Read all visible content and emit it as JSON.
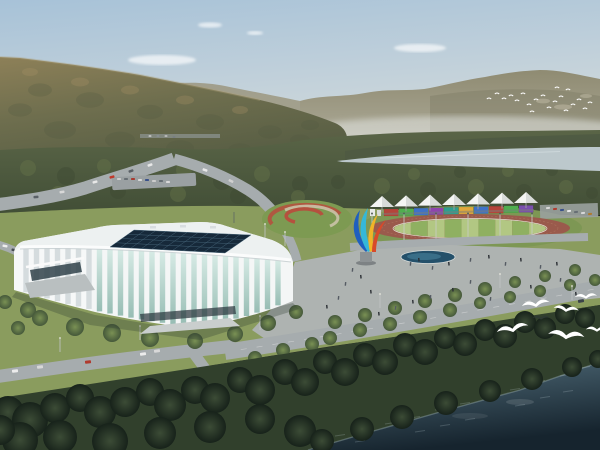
{
  "scene": {
    "description": "Aerial rendering of a lakeside sports park: white lattice gymnasium with navy glass skylight roof, athletics track with rainbow grandstand and white canopy tents, colorful ribbon sculpture, plazas with pedestrians, tree-lined roads, forested mountains, a pale river, flying egrets and dark blue water in the foreground."
  },
  "palette": {
    "sky_top": "#a7c2d8",
    "sky_haze": "#dadfe0",
    "far_range": "#8f8b72",
    "far_range_base": "#b0ac9a",
    "ridge_haze": "#9b977f",
    "mountain_light": "#97875f",
    "mountain_dark": "#5e6246",
    "forest": "#5a6547",
    "forest_dark": "#414e36",
    "river": "#bcc8cc",
    "lawn": "#8a9c5e",
    "plaza": "#aeb3b1",
    "road": "#a6acae",
    "track": "#9a5a4c",
    "field_light": "#b2c783",
    "field_dark": "#8fb061",
    "facade": "#f4f6f6",
    "roof": "#edf1f1",
    "glass_top": "#d3e9e3",
    "glass_bottom": "#8fb8ae",
    "skylight": "#16293a",
    "skylight_grid": "#4a6a7e",
    "water_top": "#54707e",
    "water_deep": "#16242e",
    "shadow": "#2f3a33",
    "bird": "#ffffff",
    "tent": "#f4f5f3",
    "tent_shade": "#d8dbd9"
  },
  "sky": {
    "clouds": [
      [
        162,
        60,
        34,
        5
      ],
      [
        210,
        25,
        12,
        2.6
      ],
      [
        255,
        33,
        8,
        2
      ],
      [
        420,
        48,
        26,
        4
      ]
    ]
  },
  "mountains": {
    "scree": [
      [
        543,
        101,
        7,
        2.4
      ],
      [
        563,
        107,
        9,
        2.6
      ],
      [
        586,
        96,
        6,
        2
      ]
    ],
    "dark_blotches": [
      [
        40,
        90,
        12
      ],
      [
        90,
        100,
        14
      ],
      [
        150,
        112,
        13
      ],
      [
        210,
        122,
        14
      ],
      [
        270,
        132,
        12
      ],
      [
        60,
        130,
        16
      ],
      [
        120,
        140,
        15
      ],
      [
        180,
        148,
        14
      ],
      [
        240,
        150,
        12
      ],
      [
        300,
        140,
        10
      ],
      [
        20,
        110,
        12
      ],
      [
        310,
        125,
        9
      ]
    ],
    "light_blotches": [
      [
        30,
        72,
        8
      ],
      [
        80,
        82,
        9
      ],
      [
        130,
        90,
        9
      ],
      [
        185,
        100,
        9
      ],
      [
        240,
        110,
        8
      ]
    ]
  },
  "forest": {
    "texture": [
      [
        28,
        168,
        8
      ],
      [
        66,
        176,
        9
      ],
      [
        104,
        166,
        7
      ],
      [
        142,
        178,
        9
      ],
      [
        184,
        170,
        8
      ],
      [
        222,
        181,
        9
      ],
      [
        262,
        174,
        8
      ],
      [
        300,
        184,
        8
      ],
      [
        58,
        193,
        7
      ],
      [
        118,
        191,
        8
      ],
      [
        178,
        194,
        8
      ],
      [
        238,
        196,
        8
      ],
      [
        298,
        197,
        7
      ],
      [
        338,
        182,
        7
      ],
      [
        382,
        186,
        8
      ],
      [
        428,
        190,
        8
      ],
      [
        476,
        187,
        8
      ],
      [
        524,
        192,
        8
      ],
      [
        566,
        187,
        7
      ],
      [
        592,
        193,
        6
      ],
      [
        414,
        174,
        6
      ],
      [
        460,
        172,
        6
      ],
      [
        508,
        171,
        6
      ],
      [
        552,
        170,
        6
      ]
    ]
  },
  "stadium": {
    "rim": [
      [
        16,
        252
      ],
      [
        22,
        247
      ],
      [
        60,
        246
      ],
      [
        120,
        248
      ],
      [
        180,
        251
      ],
      [
        240,
        255
      ],
      [
        291,
        260
      ]
    ],
    "bottom": [
      [
        14,
        290
      ],
      [
        40,
        298
      ],
      [
        70,
        306
      ],
      [
        100,
        313
      ],
      [
        130,
        319
      ],
      [
        160,
        324
      ],
      [
        185,
        327
      ],
      [
        215,
        325
      ],
      [
        245,
        318
      ],
      [
        270,
        310
      ],
      [
        293,
        301
      ]
    ],
    "rib_start": 26,
    "rib_end": 288,
    "rib_step": 10.5,
    "rib_width": 5.4,
    "left_face_max_x": 92,
    "skylight": {
      "corners": [
        [
          110,
          247
        ],
        [
          134,
          230
        ],
        [
          251,
          235
        ],
        [
          225,
          253
        ]
      ],
      "cols": 11,
      "rows": 4
    }
  },
  "grandstand": {
    "panel_colors": [
      "#b5443a",
      "#4fae4f",
      "#3f72c8",
      "#8e44ad",
      "#2e9e8f",
      "#e0a83c",
      "#3f72c8",
      "#b5443a",
      "#4fae4f",
      "#7a4fae"
    ],
    "panel_area": {
      "x0": 384,
      "x1": 534,
      "y_left": 209,
      "y_right": 205,
      "height": 7
    },
    "tents": {
      "count": 7,
      "x0": 382,
      "step": 24,
      "base_left": 207,
      "base_right": 203,
      "half_width": 12,
      "peak": 11
    },
    "flagpole_xs": [
      372,
      404,
      436,
      468,
      500,
      532
    ]
  },
  "track": {
    "cx": 470,
    "cy": 228,
    "rx_outer": 100,
    "ry_outer": 14,
    "rx_in": 76,
    "ry_in": 9.5,
    "stripes": 9
  },
  "roundabout": {
    "cx": 307,
    "cy": 219,
    "rx": 45,
    "ry": 19
  },
  "sculpture": {
    "colors": [
      "#1f5fbf",
      "#35b8d8",
      "#f0b428",
      "#d84a2a"
    ]
  },
  "trees": {
    "mid": [
      [
        5,
        302,
        7
      ],
      [
        28,
        310,
        8
      ],
      [
        40,
        318,
        8
      ],
      [
        75,
        327,
        9
      ],
      [
        112,
        333,
        9
      ],
      [
        150,
        338,
        9
      ],
      [
        195,
        341,
        8
      ],
      [
        235,
        334,
        8
      ],
      [
        268,
        323,
        8
      ],
      [
        296,
        312,
        7
      ],
      [
        18,
        328,
        7
      ],
      [
        255,
        358,
        7
      ],
      [
        283,
        350,
        7
      ],
      [
        312,
        344,
        7
      ],
      [
        335,
        322,
        7
      ],
      [
        365,
        315,
        7
      ],
      [
        395,
        308,
        7
      ],
      [
        425,
        301,
        7
      ],
      [
        455,
        295,
        7
      ],
      [
        485,
        289,
        7
      ],
      [
        515,
        282,
        6
      ],
      [
        545,
        276,
        6
      ],
      [
        575,
        270,
        6
      ],
      [
        330,
        338,
        7
      ],
      [
        360,
        330,
        7
      ],
      [
        390,
        324,
        7
      ],
      [
        420,
        317,
        7
      ],
      [
        450,
        310,
        7
      ],
      [
        480,
        303,
        6
      ],
      [
        510,
        297,
        6
      ],
      [
        540,
        291,
        6
      ],
      [
        570,
        285,
        6
      ],
      [
        595,
        280,
        6
      ]
    ],
    "fore": [
      [
        8,
        412,
        16
      ],
      [
        30,
        420,
        18
      ],
      [
        55,
        408,
        15
      ],
      [
        80,
        398,
        14
      ],
      [
        100,
        412,
        16
      ],
      [
        125,
        402,
        15
      ],
      [
        150,
        392,
        14
      ],
      [
        170,
        405,
        16
      ],
      [
        195,
        390,
        14
      ],
      [
        215,
        398,
        15
      ],
      [
        240,
        380,
        13
      ],
      [
        260,
        390,
        15
      ],
      [
        285,
        372,
        13
      ],
      [
        305,
        382,
        14
      ],
      [
        325,
        362,
        12
      ],
      [
        345,
        372,
        14
      ],
      [
        365,
        355,
        12
      ],
      [
        385,
        362,
        13
      ],
      [
        405,
        345,
        12
      ],
      [
        425,
        352,
        13
      ],
      [
        445,
        338,
        11
      ],
      [
        465,
        344,
        12
      ],
      [
        485,
        330,
        11
      ],
      [
        505,
        336,
        12
      ],
      [
        525,
        322,
        11
      ],
      [
        545,
        328,
        11
      ],
      [
        565,
        314,
        10
      ],
      [
        585,
        318,
        10
      ],
      [
        20,
        440,
        18
      ],
      [
        60,
        437,
        17
      ],
      [
        110,
        441,
        18
      ],
      [
        160,
        433,
        16
      ],
      [
        210,
        427,
        16
      ],
      [
        260,
        419,
        15
      ],
      [
        300,
        431,
        16
      ],
      [
        0,
        430,
        15
      ]
    ],
    "shore": [
      [
        322,
        441,
        12
      ],
      [
        362,
        429,
        12
      ],
      [
        402,
        417,
        12
      ],
      [
        446,
        403,
        12
      ],
      [
        490,
        391,
        11
      ],
      [
        532,
        379,
        11
      ],
      [
        572,
        367,
        10
      ],
      [
        598,
        359,
        9
      ]
    ]
  },
  "vehicles": [
    [
      150,
      165,
      5,
      2.5,
      "#e8e8e8",
      -18
    ],
    [
      131,
      171,
      5,
      2.5,
      "#5a6066",
      -18
    ],
    [
      112,
      177,
      5,
      2.5,
      "#c0392b",
      -16
    ],
    [
      95,
      182,
      5,
      2.5,
      "#e8e8e8",
      -14
    ],
    [
      62,
      192,
      5,
      2.5,
      "#d8d8d8",
      -8
    ],
    [
      36,
      197,
      5,
      2.5,
      "#5a6066",
      -6
    ],
    [
      205,
      170,
      5,
      2.5,
      "#e8e8e8",
      20
    ],
    [
      231,
      181,
      5,
      2.5,
      "#d0d0d0",
      26
    ],
    [
      5,
      246,
      5,
      2.5,
      "#eeeeee",
      10
    ],
    [
      14,
      250,
      5,
      2.5,
      "#444a50",
      10
    ],
    [
      15,
      371,
      6,
      3,
      "#ececec",
      -6
    ],
    [
      40,
      367,
      6,
      3,
      "#d8d8d8",
      -6
    ],
    [
      88,
      362,
      6,
      3,
      "#b03a2e",
      -7
    ],
    [
      143,
      354,
      6,
      3,
      "#ececec",
      -8
    ],
    [
      157,
      351,
      6,
      3,
      "#d8d8d8",
      -8
    ],
    [
      512,
      341,
      7,
      3.5,
      "#f2f2f2",
      -10
    ],
    [
      581,
      301,
      6,
      3,
      "#3a4248",
      -10
    ],
    [
      119,
      179,
      4,
      2,
      "#cccccc",
      0
    ],
    [
      126,
      179,
      4,
      2,
      "#666e74",
      0
    ],
    [
      133,
      179,
      4,
      2,
      "#a83a30",
      0
    ],
    [
      140,
      180,
      4,
      2,
      "#d8d8d8",
      0
    ],
    [
      147,
      180,
      4,
      2,
      "#39518a",
      0
    ],
    [
      154,
      181,
      4,
      2,
      "#cccccc",
      0
    ],
    [
      161,
      181,
      4,
      2,
      "#666e74",
      0
    ],
    [
      168,
      182,
      4,
      2,
      "#d8d8d8",
      0
    ],
    [
      150,
      136,
      3,
      1.5,
      "#d0d0d0",
      0
    ],
    [
      158,
      136,
      3,
      1.5,
      "#8a9096",
      0
    ],
    [
      166,
      136,
      3,
      1.5,
      "#c8c8c8",
      0
    ],
    [
      174,
      137,
      3,
      1.5,
      "#777d83",
      0
    ],
    [
      548,
      208,
      4,
      2,
      "#d8d8d8",
      -4
    ],
    [
      555,
      209,
      4,
      2,
      "#b03a2e",
      -4
    ],
    [
      562,
      210,
      4,
      2,
      "#39518a",
      -4
    ],
    [
      569,
      211,
      4,
      2,
      "#e8e8e8",
      -4
    ],
    [
      576,
      212,
      4,
      2,
      "#666e74",
      -4
    ],
    [
      583,
      213,
      4,
      2,
      "#d8d8d8",
      -4
    ],
    [
      590,
      214,
      4,
      2,
      "#b07a2e",
      -4
    ]
  ],
  "people": [
    [
      352,
      268
    ],
    [
      360,
      275
    ],
    [
      345,
      282
    ],
    [
      370,
      290
    ],
    [
      410,
      262
    ],
    [
      418,
      258
    ],
    [
      432,
      266
    ],
    [
      448,
      262
    ],
    [
      470,
      258
    ],
    [
      488,
      255
    ],
    [
      505,
      262
    ],
    [
      520,
      258
    ],
    [
      540,
      265
    ],
    [
      556,
      262
    ],
    [
      470,
      280
    ],
    [
      452,
      288
    ],
    [
      430,
      295
    ],
    [
      412,
      300
    ],
    [
      395,
      306
    ],
    [
      378,
      312
    ],
    [
      490,
      297
    ],
    [
      530,
      285
    ],
    [
      560,
      278
    ],
    [
      575,
      292
    ],
    [
      338,
      296
    ],
    [
      326,
      305
    ]
  ],
  "poles": [
    [
      60,
      352
    ],
    [
      140,
      340
    ],
    [
      260,
      330
    ],
    [
      380,
      308
    ],
    [
      500,
      288
    ],
    [
      572,
      300
    ],
    [
      265,
      238
    ],
    [
      285,
      246
    ]
  ],
  "birds": {
    "flock": [
      [
        489,
        99
      ],
      [
        497,
        94
      ],
      [
        504,
        99
      ],
      [
        511,
        96
      ],
      [
        517,
        101
      ],
      [
        523,
        94
      ],
      [
        529,
        105
      ],
      [
        536,
        100
      ],
      [
        543,
        96
      ],
      [
        549,
        108
      ],
      [
        555,
        102
      ],
      [
        561,
        97
      ],
      [
        566,
        111
      ],
      [
        573,
        105
      ],
      [
        579,
        100
      ],
      [
        585,
        109
      ],
      [
        590,
        103
      ],
      [
        568,
        90
      ],
      [
        557,
        88
      ],
      [
        532,
        112
      ]
    ],
    "gulls": [
      [
        536,
        306,
        1.0,
        -8,
        0
      ],
      [
        566,
        311,
        0.9,
        6,
        0
      ],
      [
        586,
        298,
        0.8,
        -4,
        0
      ],
      [
        513,
        331,
        1.15,
        -12,
        0
      ],
      [
        566,
        338,
        1.3,
        5,
        0
      ],
      [
        597,
        331,
        0.8,
        0,
        0
      ],
      [
        541,
        319,
        0.6,
        0,
        1
      ]
    ]
  },
  "water": {
    "ripples": [
      [
        340,
        436
      ],
      [
        365,
        430
      ],
      [
        390,
        424
      ],
      [
        415,
        418
      ],
      [
        440,
        410
      ],
      [
        465,
        404
      ],
      [
        490,
        396
      ],
      [
        515,
        390
      ],
      [
        540,
        382
      ],
      [
        565,
        376
      ],
      [
        420,
        432
      ],
      [
        470,
        420
      ],
      [
        520,
        406
      ],
      [
        568,
        392
      ],
      [
        360,
        442
      ],
      [
        585,
        368
      ],
      [
        445,
        426
      ],
      [
        545,
        398
      ]
    ]
  }
}
